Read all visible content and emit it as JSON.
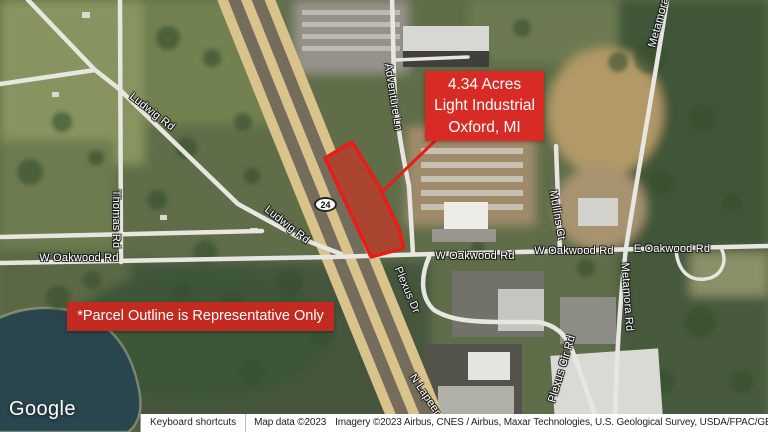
{
  "map": {
    "callout": {
      "acreage": "4.34 Acres",
      "zoning": "Light Industrial",
      "location": "Oxford, MI"
    },
    "disclaimer": "*Parcel Outline is Representative Only",
    "route_shield": "24",
    "roads": {
      "ludwig_upper": "Ludwig Rd",
      "ludwig_lower": "Ludwig Rd",
      "thomas": "Thomas Rd",
      "adventure": "Adventure Ln",
      "w_oakwood_west": "W Oakwood Rd",
      "w_oakwood_mid": "W Oakwood Rd",
      "w_oakwood_east": "W Oakwood Rd",
      "e_oakwood": "E Oakwood Rd",
      "plexus_dr": "Plexus Dr",
      "plexus_cir": "Plexus Cir Rd",
      "mullins": "Mullins Ct",
      "metamora_north": "Metamora Rd",
      "metamora_south": "Metamora Rd",
      "n_lapeer": "N Lapeer Rd"
    },
    "colors": {
      "callout_red": "#d92b26",
      "disclaimer_red": "#c32a20",
      "parcel_fill": "rgba(200,30,22,0.5)",
      "parcel_stroke": "#e81d15"
    },
    "logo": "Google",
    "footer": {
      "keyboard_shortcuts": "Keyboard shortcuts",
      "map_data": "Map data ©2023",
      "imagery": "Imagery ©2023 Airbus, CNES / Airbus, Maxar Technologies, U.S. Geological Survey, USDA/FPAC/GEO"
    }
  }
}
